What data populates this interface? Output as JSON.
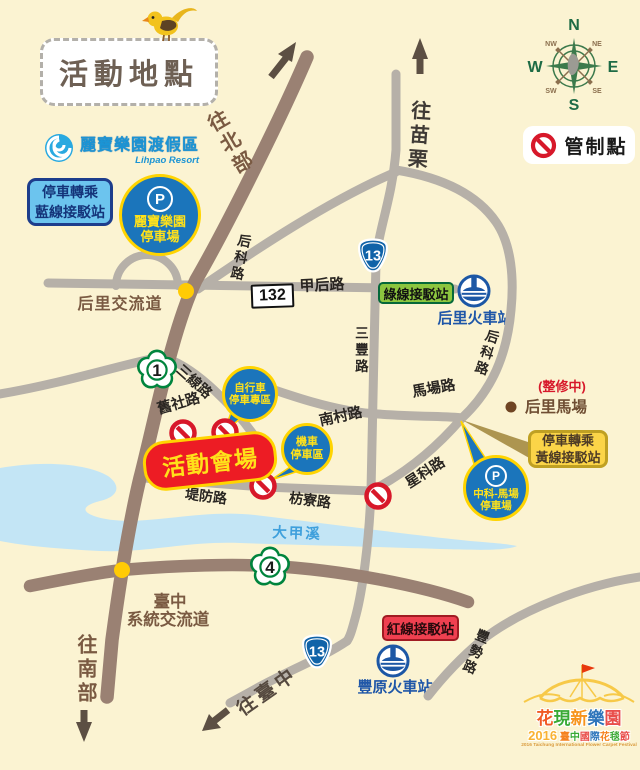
{
  "title": "活動地點",
  "legend": {
    "control_point": "管制點"
  },
  "compass": {
    "n": "N",
    "e": "E",
    "s": "S",
    "w": "W",
    "nw": "NW",
    "ne": "NE",
    "sw": "SW",
    "se": "SE"
  },
  "lihpao_logo": {
    "name": "麗寶樂園渡假區",
    "subtitle": "Lihpao Resort"
  },
  "badges": {
    "blue_transfer_line1": "停車轉乘",
    "blue_transfer_line2": "藍線接駁站",
    "lihpao_parking_p": "P",
    "lihpao_parking_line1": "麗寶樂園",
    "lihpao_parking_line2": "停車場",
    "green_shuttle": "綠線接駁站",
    "red_shuttle": "紅線接駁站",
    "yellow_transfer_line1": "停車轉乘",
    "yellow_transfer_line2": "黃線接駁站",
    "zhongke_p": "P",
    "zhongke_line1": "中科-馬場",
    "zhongke_line2": "停車場",
    "bike_line1": "自行車",
    "bike_line2": "停車專區",
    "moto_line1": "機車",
    "moto_line2": "停車區",
    "venue": "活動會場",
    "horse_ranch": "后里馬場",
    "horse_ranch_note": "(整修中)"
  },
  "stations": {
    "houli": "后里火車站",
    "fengyuan": "豐原火車站"
  },
  "interchanges": {
    "houli": "后里交流道",
    "taichung_line1": "臺中",
    "taichung_line2": "系統交流道"
  },
  "river": "大甲溪",
  "directions": {
    "north": "往北部",
    "miaoli": "往苗栗",
    "south": "往南部",
    "taichung": "往臺中"
  },
  "roads": {
    "houke_north": "后科路",
    "houke_east": "后科路",
    "jiahou": "甲后路",
    "sanfeng": "三豐路",
    "machang": "馬場路",
    "nancun": "南村路",
    "sanxian": "三線路",
    "jiushe": "舊社路",
    "difang": "堤防路",
    "fangliao": "枋寮路",
    "xingke": "星科路",
    "fengshi": "豐勢路"
  },
  "shields": {
    "national_1": "1",
    "national_4": "4",
    "provincial_13_north": "13",
    "provincial_13_south": "13",
    "county_132": "132"
  },
  "festival": {
    "title_chars": [
      "花",
      "現",
      "新",
      "樂",
      "園"
    ],
    "year": "2016",
    "name_chars": [
      "臺",
      "中",
      "國",
      "際",
      "花",
      "毯",
      "節"
    ],
    "english": "2016 Taichung International Flower Carpet Festival"
  },
  "colors": {
    "background": "#FBF3D2",
    "highway_brown": "#9A8173",
    "road_gray": "#B6B0A8",
    "river_blue": "#C3E5F5",
    "control_red": "#D7182A",
    "balloon_blue": "#1B75BB",
    "balloon_border_yellow": "#FFD400",
    "venue_red": "#ED1C24",
    "shuttle_green": "#8CC63F",
    "shuttle_red": "#EF4050",
    "transfer_blue": "#6CC4EE",
    "transfer_yellow": "#FBD448",
    "station_blue": "#1E56A8",
    "interchange_dot": "#FFCB05"
  }
}
